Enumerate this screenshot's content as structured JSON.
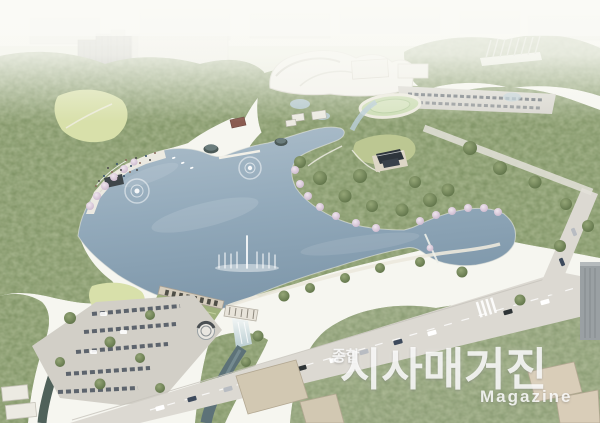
{
  "watermark": {
    "prefix": "종합",
    "title": "시사매거진",
    "subtitle": "Magazine"
  },
  "colors": {
    "sky": "#f6f6f0",
    "haze": "#faf9f4",
    "water_light": "#aebfcb",
    "water": "#93aabb",
    "water_deep": "#7e97aa",
    "forest": "#7e9163",
    "forest_sage": "#8d9c77",
    "forest_dark": "#55693f",
    "lawn": "#d8e0aa",
    "road": "#dcd9d2",
    "parking": "#d2cfc7",
    "concrete": "#d6cebe",
    "building_tan": "#d2c8b2",
    "building_white": "#eceae2",
    "building_gray": "#9aa0a3",
    "blossom": "#e2d2e0",
    "stream": "#5d7278",
    "watermark_white": "rgba(255,255,255,0.84)"
  }
}
